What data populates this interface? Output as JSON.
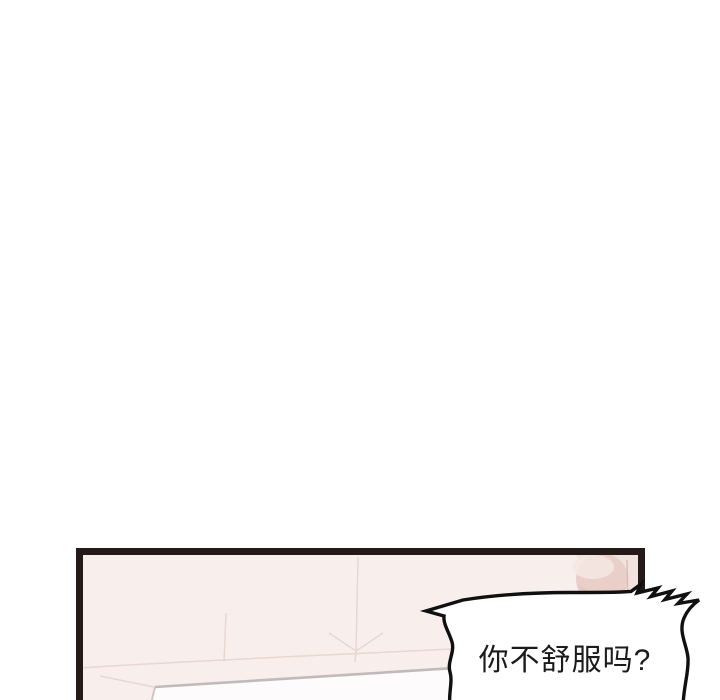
{
  "page": {
    "background": "#ffffff"
  },
  "panel": {
    "background": "#f8efec",
    "border_color": "#241a17",
    "crease_color": "#e7d4ce",
    "bed": {
      "fill": "#fdfbfb",
      "edge_color": "#c2b9ba"
    },
    "corner_object": {
      "surround": "#f1e2dd",
      "base": "#e9cfc7",
      "highlight": "#f6e8e3",
      "shadow": "#dfc0b7",
      "edge": "#d6b7ae"
    }
  },
  "speech_bubble": {
    "text": "你不舒服吗?",
    "fill": "#ffffff",
    "outline": "#101010",
    "text_color": "#1b1b1b"
  }
}
